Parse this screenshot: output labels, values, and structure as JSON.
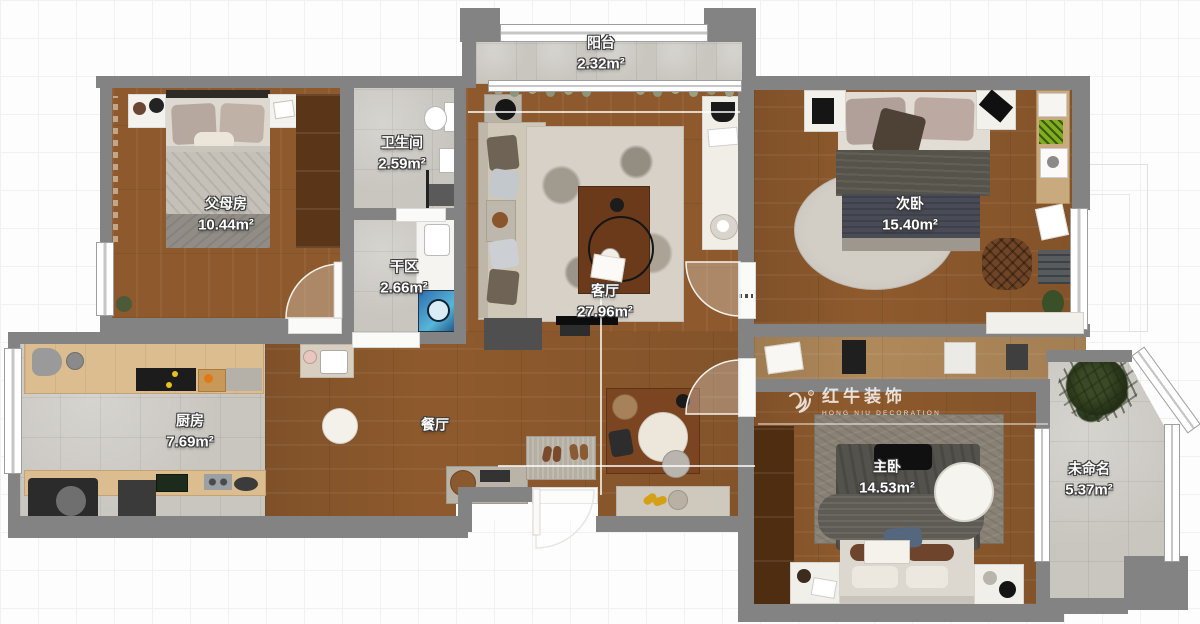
{
  "watermark": {
    "brand": "红牛装饰",
    "sub": "HONG NIU DECORATION",
    "reg": "®"
  },
  "rooms": {
    "balcony": {
      "name": "阳台",
      "area": "2.32m²"
    },
    "parents": {
      "name": "父母房",
      "area": "10.44m²"
    },
    "bathroom": {
      "name": "卫生间",
      "area": "2.59m²"
    },
    "dry": {
      "name": "干区",
      "area": "2.66m²"
    },
    "living": {
      "name": "客厅",
      "area": "27.96m²"
    },
    "second": {
      "name": "次卧",
      "area": "15.40m²"
    },
    "kitchen": {
      "name": "厨房",
      "area": "7.69m²"
    },
    "dining": {
      "name": "餐厅"
    },
    "master": {
      "name": "主卧",
      "area": "14.53m²"
    },
    "unnamed": {
      "name": "未命名",
      "area": "5.37m²"
    }
  }
}
